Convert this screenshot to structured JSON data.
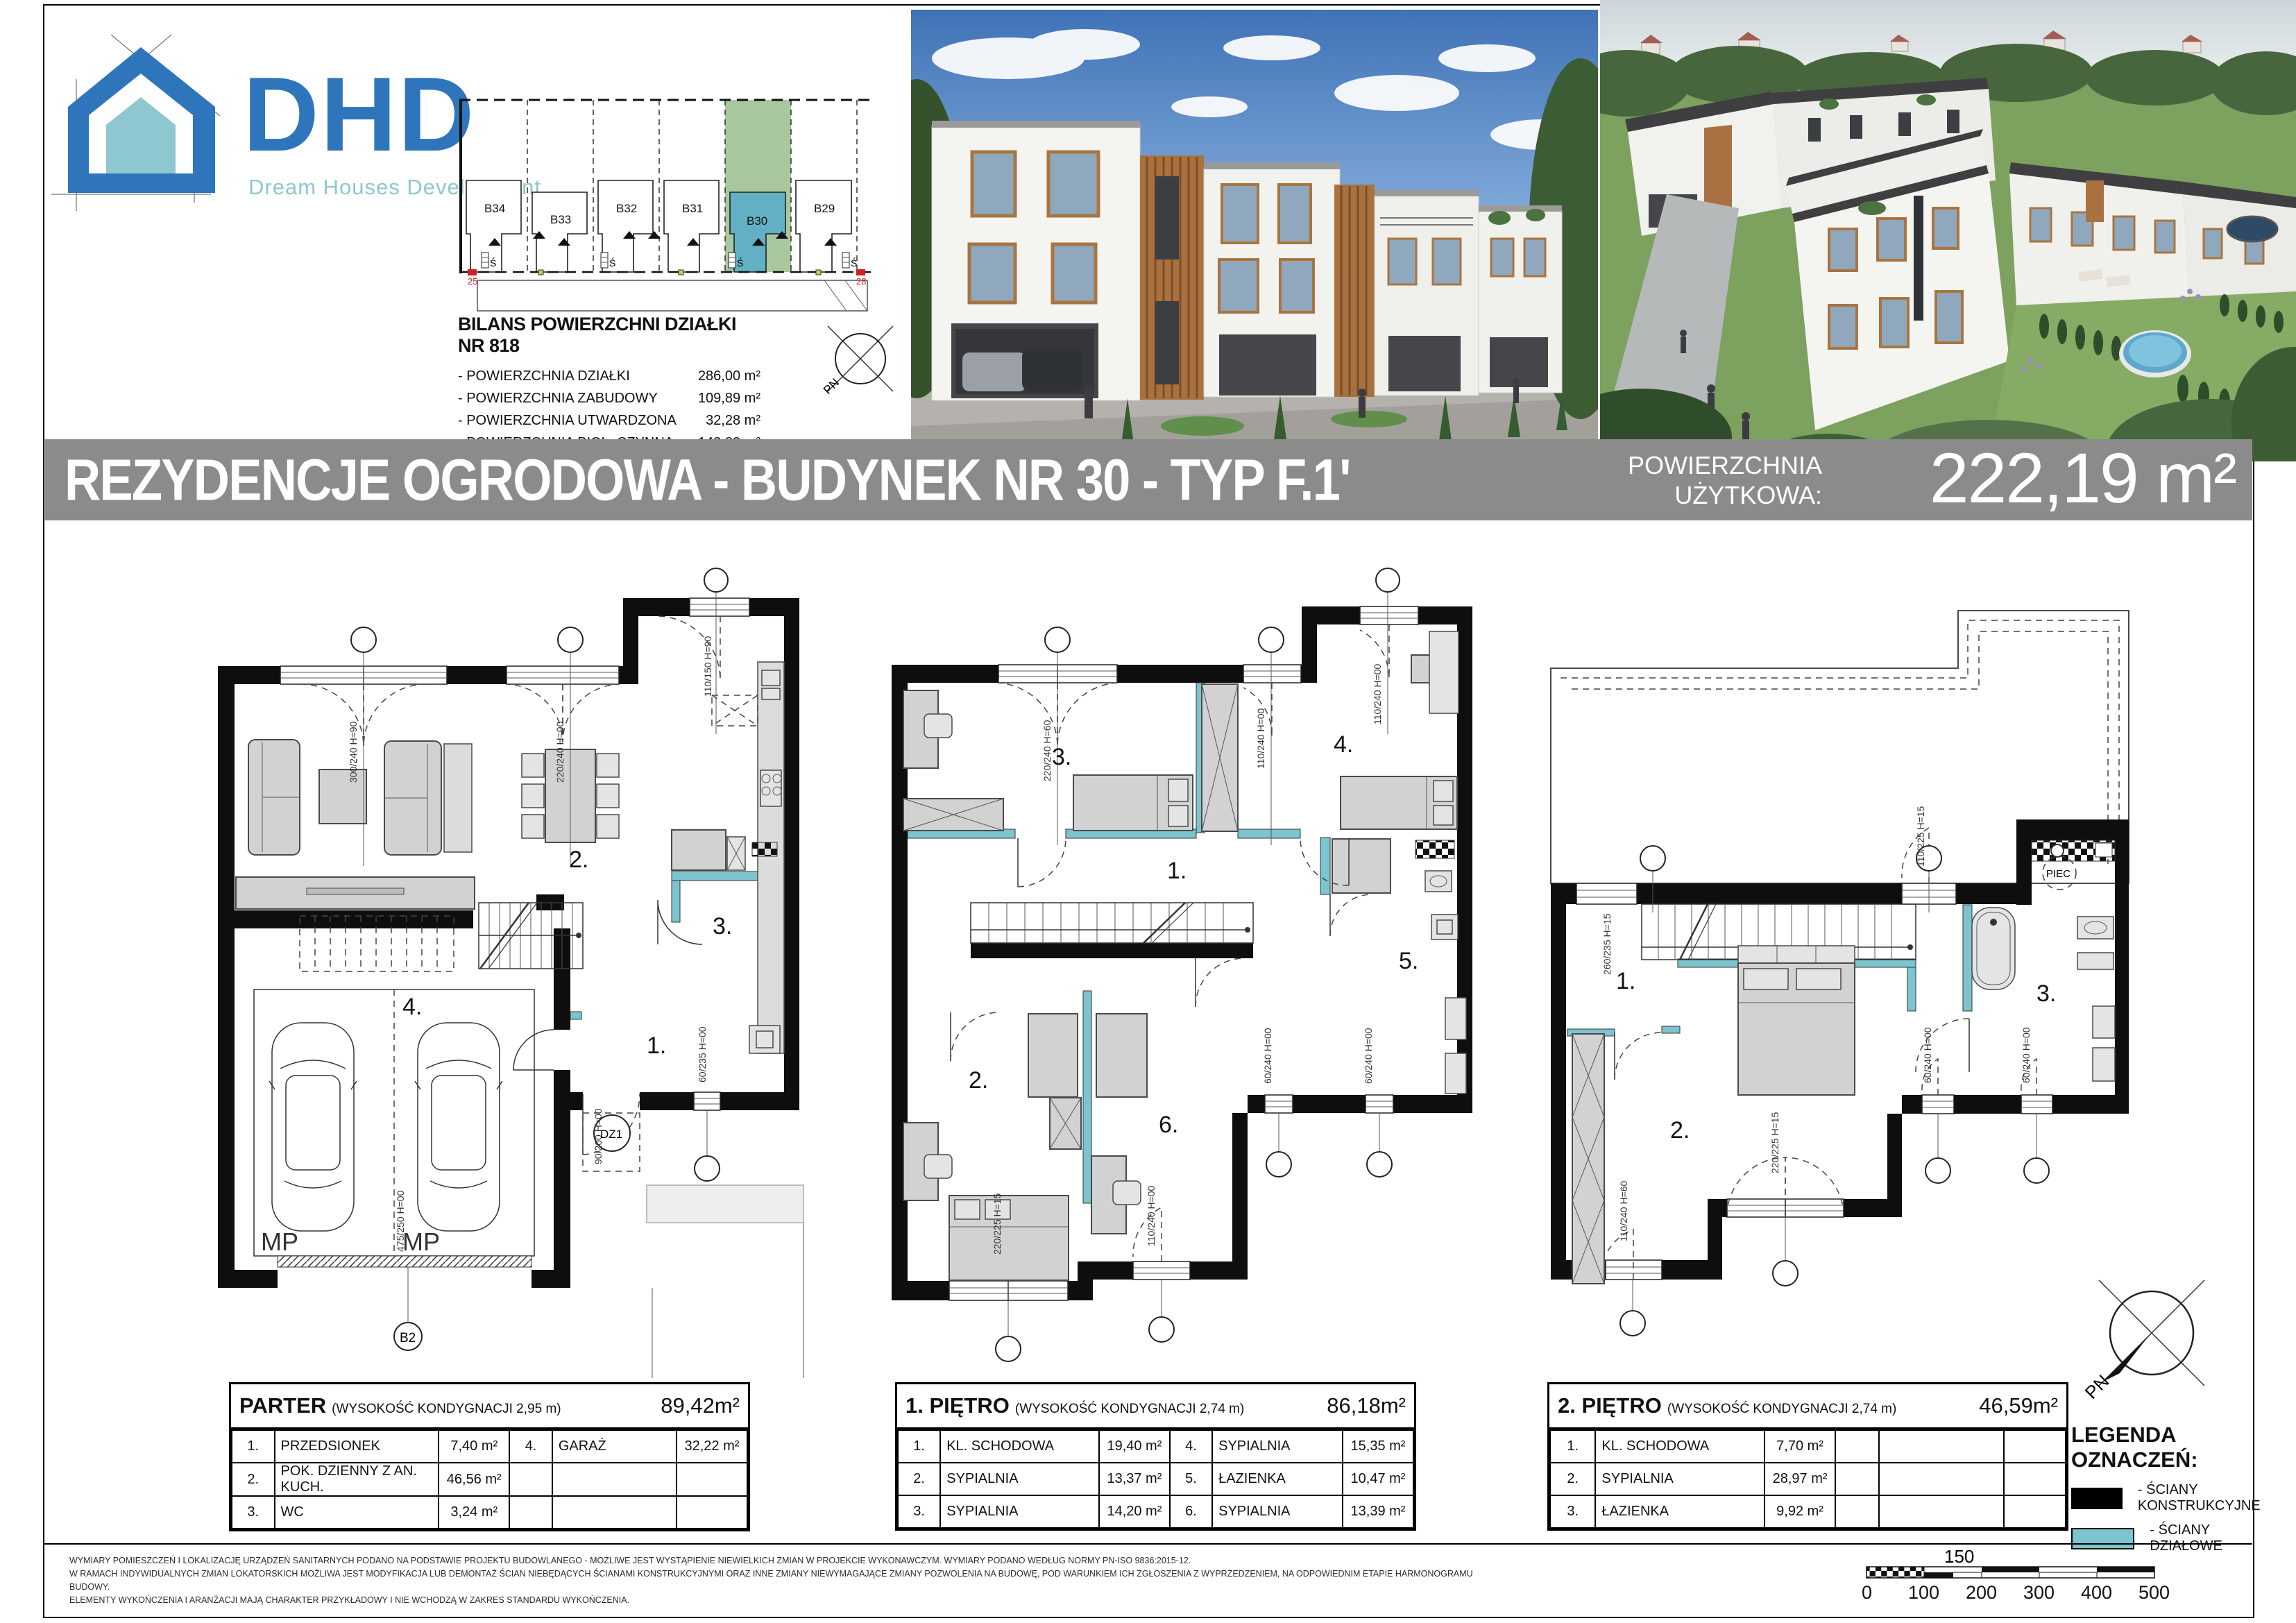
{
  "logo": {
    "name": "DHD",
    "subtitle": "Dream Houses Development"
  },
  "site_plan": {
    "plots": [
      "B34",
      "B33",
      "B32",
      "B31",
      "B30",
      "B29"
    ],
    "s_mark": "Ś",
    "corner_left": "25",
    "corner_right": "28"
  },
  "bilans": {
    "title": "BILANS POWIERZCHNI DZIAŁKI NR 818",
    "rows": [
      {
        "label": "- POWIERZCHNIA DZIAŁKI",
        "value": "286,00 m²"
      },
      {
        "label": "- POWIERZCHNIA ZABUDOWY",
        "value": "109,89 m²"
      },
      {
        "label": "- POWIERZCHNIA  UTWARDZONA",
        "value": "32,28 m²"
      },
      {
        "label": "- POWIERZCHNIA  BIOL. CZYNNA",
        "value": "143,83 m²"
      }
    ]
  },
  "compass": {
    "pn": "PN"
  },
  "title_bar": {
    "title": "REZYDENCJE OGRODOWA - BUDYNEK NR 30 - TYP F.1'",
    "area_label_1": "POWIERZCHNIA",
    "area_label_2": "UŻYTKOWA:",
    "area_value": "222,19 m²"
  },
  "floors": [
    {
      "title": "PARTER",
      "note": "(WYSOKOŚĆ KONDYGNACJI  2,95 m)",
      "total": "89,42m²",
      "rows": [
        [
          "1.",
          "PRZEDSIONEK",
          "7,40 m²",
          "4.",
          "GARAŻ",
          "32,22 m²"
        ],
        [
          "2.",
          "POK. DZIENNY Z AN. KUCH.",
          "46,56 m²",
          "",
          "",
          ""
        ],
        [
          "3.",
          "WC",
          "3,24 m²",
          "",
          "",
          ""
        ]
      ]
    },
    {
      "title": "1. PIĘTRO",
      "note": "(WYSOKOŚĆ KONDYGNACJI  2,74 m)",
      "total": "86,18m²",
      "rows": [
        [
          "1.",
          "KL. SCHODOWA",
          "19,40 m²",
          "4.",
          "SYPIALNIA",
          "15,35 m²"
        ],
        [
          "2.",
          "SYPIALNIA",
          "13,37 m²",
          "5.",
          "ŁAZIENKA",
          "10,47 m²"
        ],
        [
          "3.",
          "SYPIALNIA",
          "14,20 m²",
          "6.",
          "SYPIALNIA",
          "13,39 m²"
        ]
      ]
    },
    {
      "title": "2. PIĘTRO",
      "note": "(WYSOKOŚĆ KONDYGNACJI  2,74 m)",
      "total": "46,59m²",
      "rows": [
        [
          "1.",
          "KL. SCHODOWA",
          "7,70 m²",
          "",
          "",
          ""
        ],
        [
          "2.",
          "SYPIALNIA",
          "28,97 m²",
          "",
          "",
          ""
        ],
        [
          "3.",
          "ŁAZIENKA",
          "9,92 m²",
          "",
          "",
          ""
        ]
      ]
    }
  ],
  "plans": {
    "parter": {
      "r1": "1.",
      "r2": "2.",
      "r3": "3.",
      "r4": "4.",
      "mp1": "MP",
      "mp2": "MP",
      "dz1": "DZ1",
      "axis_b2": "B2",
      "dim_w1": "300/240 H=90",
      "dim_w2": "220/240 H=00",
      "dim_w3": "110/150 H=90",
      "dim_d1": "90/200 H=00",
      "dim_d2": "60/235 H=00",
      "dim_g": "475/250 H=00"
    },
    "p1": {
      "r1": "1.",
      "r2": "2.",
      "r3": "3.",
      "r4": "4.",
      "r5": "5.",
      "r6": "6.",
      "dim_w1": "220/240 H=60",
      "dim_w2": "110/240 H=00",
      "dim_w3": "110/240 H=00",
      "dim_b1": "220/225 H=15",
      "dim_b2": "110/240 H=00",
      "dim_s1": "60/240 H=00",
      "dim_s2": "60/240 H=00"
    },
    "p2": {
      "r1": "1.",
      "r2": "2.",
      "r3": "3.",
      "piec": "PIEC",
      "dim_w1": "260/235 H=15",
      "dim_t": "110/225 H=15",
      "dim_b": "220/225 H=15",
      "dim_l": "110/240 H=60",
      "dim_s1": "60/240 H=00",
      "dim_s2": "60/240 H=00"
    }
  },
  "legend": {
    "title": "LEGENDA OZNACZEŃ:",
    "items": [
      {
        "label": "- ŚCIANY KONSTRUKCYJNE",
        "color": "#000000"
      },
      {
        "label": "- ŚCIANY DZIAŁOWE",
        "color": "#7cc4cf"
      }
    ]
  },
  "footer": {
    "lines": [
      "WYMIARY POMIESZCZEŃ I LOKALIZACJĘ URZĄDZEŃ SANITARNYCH PODANO NA PODSTAWIE PROJEKTU BUDOWLANEGO - MOŻLIWE JEST WYSTĄPIENIE NIEWIELKICH ZMIAN W PROJEKCIE WYKONAWCZYM. WYMIARY PODANO WEDŁUG NORMY PN-ISO 9836:2015-12.",
      "W RAMACH INDYWIDUALNYCH ZMIAN LOKATORSKICH MOŻLIWA JEST MODYFIKACJA LUB DEMONTAŻ ŚCIAN NIEBĘDĄCYCH ŚCIANAMI KONSTRUKCYJNYMI ORAZ INNE ZMIANY NIEWYMAGAJĄCE ZMIANY POZWOLENIA NA BUDOWĘ, POD WARUNKIEM ICH ZGŁOSZENIA Z WYPRZEDZENIEM, NA ODPOWIEDNIM ETAPIE HARMONOGRAMU BUDOWY.",
      "ELEMENTY WYKOŃCZENIA I ARANŻACJI MAJĄ CHARAKTER PRZYKŁADOWY I NIE WCHODZĄ W ZAKRES STANDARDU WYKOŃCZENIA."
    ]
  },
  "scale_bar": {
    "mid_label": "150",
    "labels": [
      "0",
      "100",
      "200",
      "300",
      "400",
      "500"
    ]
  }
}
